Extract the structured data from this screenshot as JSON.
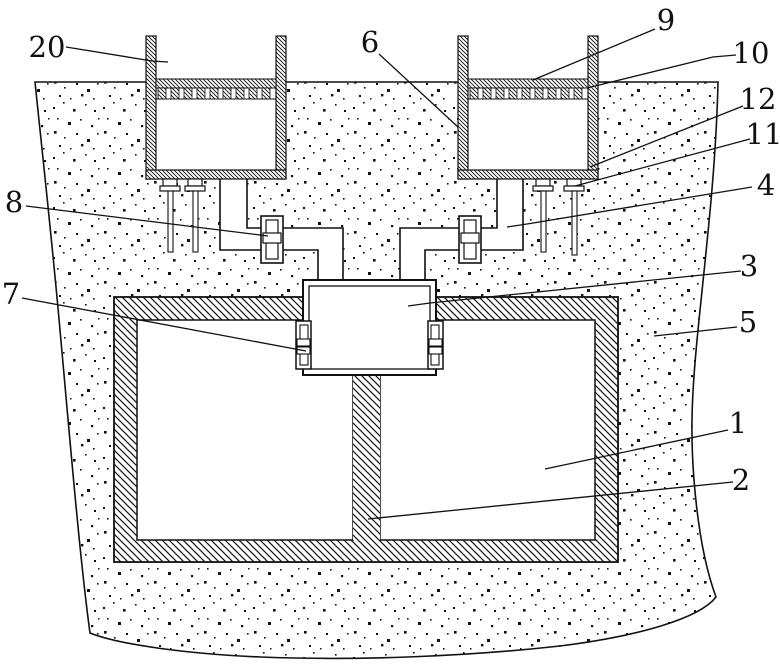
{
  "diagram": {
    "colors": {
      "ink": "#111111",
      "paper": "#ffffff"
    },
    "labels": {
      "l20": "20",
      "l6": "6",
      "l9": "9",
      "l10": "10",
      "l12": "12",
      "l11": "11",
      "l4": "4",
      "l8": "8",
      "l3": "3",
      "l7": "7",
      "l5": "5",
      "l1": "1",
      "l2": "2"
    }
  }
}
